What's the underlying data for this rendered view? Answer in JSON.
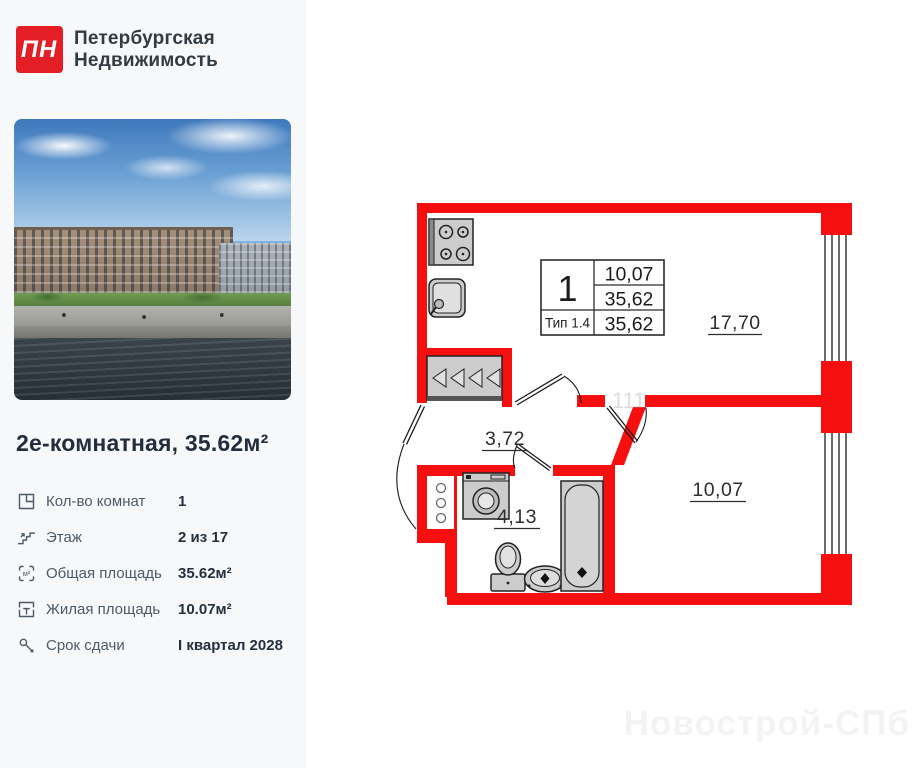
{
  "brand": {
    "logo_text": "ПН",
    "name_line1": "Петербургская",
    "name_line2": "Недвижимость"
  },
  "listing": {
    "title": "2е-комнатная, 35.62м²"
  },
  "specs": [
    {
      "icon": "rooms-icon",
      "label": "Кол-во комнат",
      "value": "1"
    },
    {
      "icon": "floor-icon",
      "label": "Этаж",
      "value": "2 из 17"
    },
    {
      "icon": "total-area-icon",
      "label": "Общая площадь",
      "value": "35.62м²"
    },
    {
      "icon": "living-area-icon",
      "label": "Жилая площадь",
      "value": "10.07м²"
    },
    {
      "icon": "key-icon",
      "label": "Срок сдачи",
      "value": "I квартал 2028"
    }
  ],
  "floorplan": {
    "stamp": {
      "rooms": "1",
      "type": "Тип 1.4",
      "row1": "10,07",
      "row2": "35,62",
      "row3": "35,62"
    },
    "rooms": [
      {
        "name": "living-kitchen",
        "area": "17,70"
      },
      {
        "name": "hallway",
        "area": "3,72"
      },
      {
        "name": "bathroom",
        "area": "4,13"
      },
      {
        "name": "bedroom",
        "area": "10,07"
      }
    ],
    "faint_mark": "111",
    "fixtures": [
      "stove",
      "kitchen-sink",
      "wardrobe",
      "washing-machine",
      "toilet",
      "washbasin",
      "bathtub",
      "shaft"
    ],
    "colors": {
      "wall_red": "#f50f0f",
      "logo_red": "#e31e24",
      "sidebar_bg": "#f7f8fa"
    }
  },
  "watermark": "Новострой-СПб"
}
